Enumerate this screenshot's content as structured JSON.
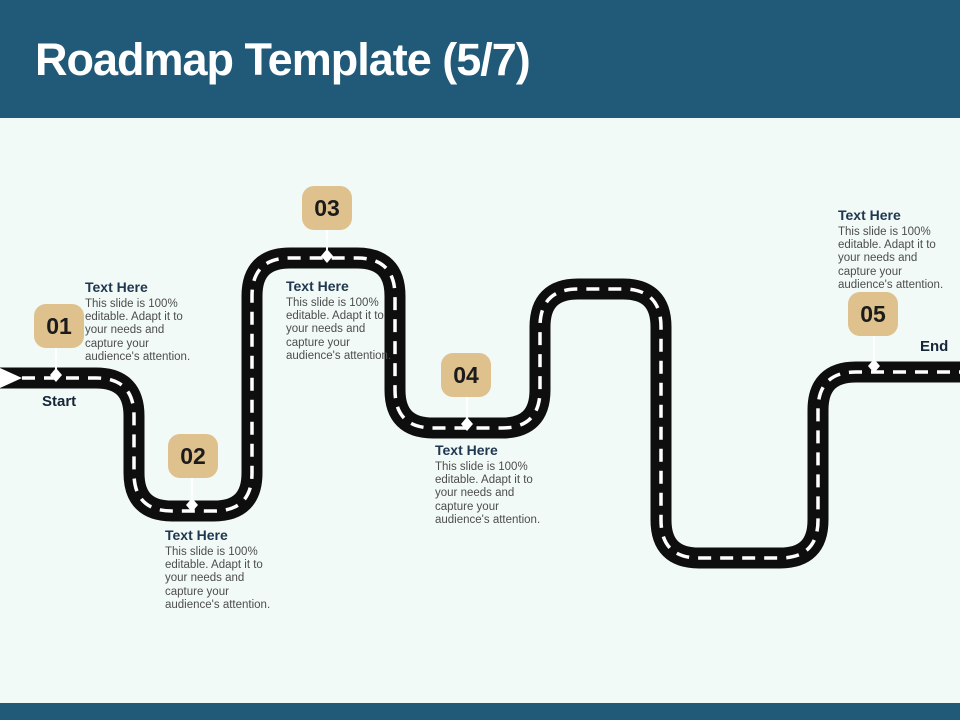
{
  "slide": {
    "title": "Roadmap Template (5/7)",
    "start_label": "Start",
    "end_label": "End"
  },
  "colors": {
    "header_bar": "#205A78",
    "footer_bar": "#205A78",
    "background": "#F2FAF8",
    "badge": "#DEC18C",
    "road": "#0E0E0E",
    "marker": "#FFFFFF",
    "title_text": "#FFFFFF",
    "heading_text": "#20384F",
    "body_text": "#4D4D4D",
    "label_text": "#142638"
  },
  "milestones": [
    {
      "number": "01",
      "title": "Text Here",
      "description": "This slide is 100%\neditable.  Adapt it to\nyour needs and\ncapture your\naudience's attention."
    },
    {
      "number": "02",
      "title": "Text Here",
      "description": "This slide is 100%\neditable.  Adapt it to\nyour needs and\ncapture your\naudience's attention."
    },
    {
      "number": "03",
      "title": "Text Here",
      "description": "This slide is 100%\neditable.  Adapt it to\nyour needs and\ncapture your\naudience's attention."
    },
    {
      "number": "04",
      "title": "Text Here",
      "description": "This slide is 100%\neditable.  Adapt it to\nyour needs and\ncapture your\naudience's attention."
    },
    {
      "number": "05",
      "title": "Text Here",
      "description": "This slide is 100%\neditable.  Adapt it to\nyour needs and\ncapture your\naudience's attention."
    }
  ]
}
